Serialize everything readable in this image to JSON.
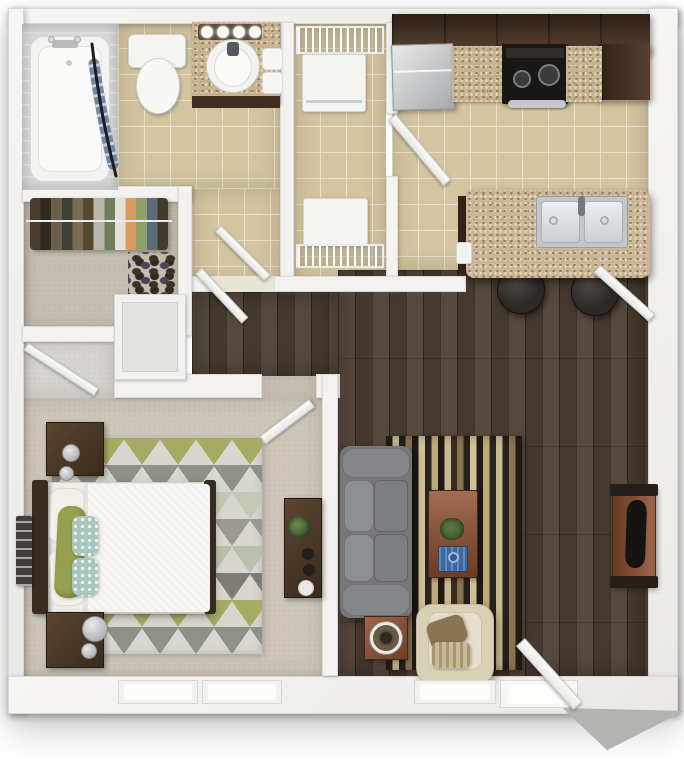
{
  "meta": {
    "type": "floor-plan-3d-top-down",
    "subject": "one-bedroom one-bath apartment with open kitchen and living room"
  },
  "palette": {
    "background": "#ffffff",
    "wall": "#f3f2f0",
    "tile_floor": "#d2c5a0",
    "hardwood": "#4e3f33",
    "bedroom_carpet": "#cdc6b9",
    "closet_carpet": "#c5beb1",
    "nook_floor": "#d6d4cf",
    "cabinet_dark": "#46301f",
    "granite": "#c6b191",
    "island_granite": "#cbb697",
    "stainless": "#ccced0",
    "couch_grey": "#77787b",
    "armchair_cream": "#d9d0b5",
    "cherry_wood": "#8c4c2c",
    "dark_wood": "#4a3828",
    "bed_white": "#f8f7f3",
    "pillow_green": "#96a04f",
    "pillow_teal": "#a7c6be",
    "rug_base": "#d8d7cf",
    "stool_dark": "#2c2824",
    "tray_blue": "#3a68a0",
    "door_white": "#f7f7f5",
    "door_shadow_grey": "#b3b3b0",
    "appliance_white": "#f4f4f2",
    "tub_surround": "#d8d9da"
  },
  "closet": {
    "clothes_colors": [
      "#4a3b2a",
      "#2f2a22",
      "#6b5d48",
      "#3d4033",
      "#7a6c54",
      "#56492f",
      "#b9b5a8",
      "#6f7d5a",
      "#e3e1d8",
      "#d89a5e",
      "#8fa06b",
      "#5c6b78",
      "#433a2c"
    ]
  },
  "living": {
    "rug_stripes": [
      "#26201a",
      "#c9b98e",
      "#26201a",
      "#8b7452",
      "#1f1a15",
      "#cfc096",
      "#2b241d",
      "#bfa87b",
      "#1f1a15",
      "#c9b98e",
      "#362c22",
      "#8b7452",
      "#26201a",
      "#cfc096",
      "#1f1a15",
      "#bfa87b",
      "#2b241d",
      "#c9b98e",
      "#26201a",
      "#8b7452",
      "#241e18"
    ]
  },
  "bedroom": {
    "rug_rows": [
      "#a6aa63",
      "#8f9088",
      "#c3c9b4",
      "#9a9a93",
      "#b9c0ab",
      "#7d7d76",
      "#a6aa63",
      "#8f9088"
    ]
  }
}
